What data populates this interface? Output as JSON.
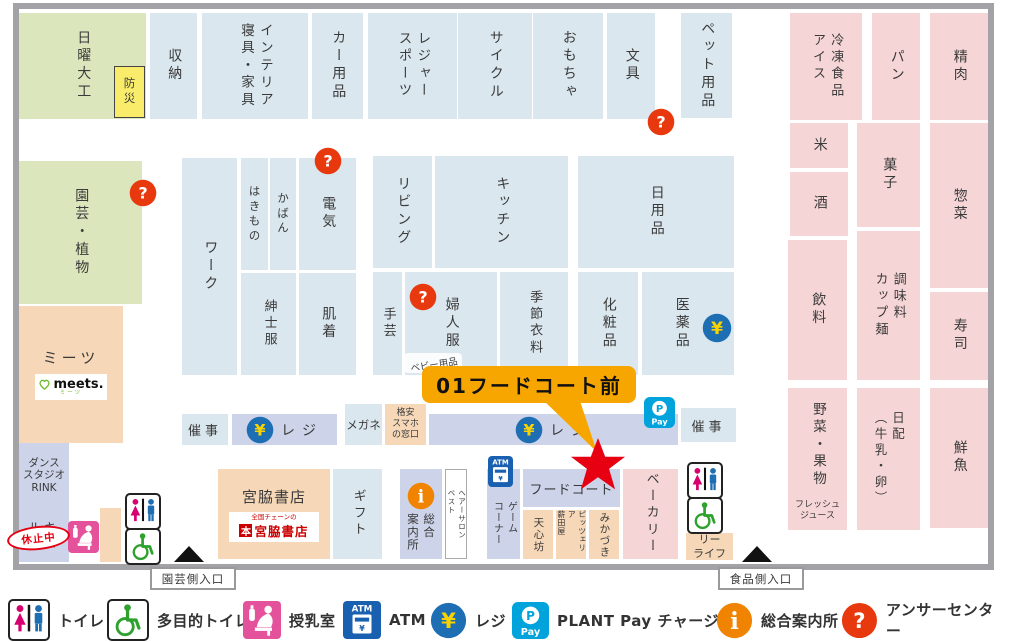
{
  "zones": {
    "sunday_diy": "日曜大工",
    "bosai": "防災",
    "storage": "収納",
    "interior": "インテリア\n寝具・家具",
    "car": "カー用品",
    "leisure": "レジャー\nスポーツ",
    "cycle": "サイクル",
    "toys": "おもちゃ",
    "stationery": "文具",
    "pet": "ペット用品",
    "frozen": "冷凍食品\nアイス",
    "bread": "パン",
    "meat": "精肉",
    "rice": "米",
    "confectionery": "菓子",
    "deli": "惣菜",
    "liquor": "酒",
    "beverages": "飲料",
    "seasoning": "調味料\nカップ麺",
    "sushi": "寿司",
    "produce": "野菜・果物",
    "fresh_juice": "フレッシュ\nジュース",
    "daily_dairy": "日配\n（牛乳・卵）",
    "fish": "鮮魚",
    "gardening": "園芸・植物",
    "meets": "ミーツ",
    "meets_logo": "meets.",
    "meets_logo_sub": "ミーツ",
    "dance_studio": "ダンス\nスタジオ\nRINK",
    "rukimuzu": "ルキ\nムズ",
    "suspended": "休止中",
    "work": "ワーク",
    "footwear": "はきもの",
    "bags": "かばん",
    "electronics": "電気",
    "mens": "紳士服",
    "underwear": "肌着",
    "living": "リビング",
    "kitchen": "キッチン",
    "daily_goods": "日用品",
    "handicraft": "手芸",
    "womens": "婦人服",
    "baby": "ベビー用品",
    "seasonal": "季節衣料",
    "cosmetics": "化粧品",
    "medicine": "医薬品",
    "saiji_left": "催事",
    "saiji_right": "催事",
    "register1": "レジ",
    "register2": "レジ",
    "glasses": "メガネ",
    "smartphone_counter": "格安\nスマホ\nの窓口",
    "miyawaki_title": "宮脇書店",
    "miyawaki_chain": "全国チェーンの",
    "miyawaki_mark": "本",
    "miyawaki_logo": "宮脇書店",
    "gift": "ギフト",
    "info_center": "総合\n案内所",
    "hair_salon": "ヘアーサロン\nベスト",
    "game_corner": "ゲーム\nコーナー",
    "food_court": "フードコート",
    "tenshinbo": "天心坊",
    "pizzeria": "ピッツェリア\n薪田屋",
    "mikazuki": "みかづき",
    "bakery": "ベーカリー",
    "lealife": "リー\nライフ"
  },
  "callout": {
    "text": "01フードコート前"
  },
  "entrances": {
    "garden": "園芸側入口",
    "food": "食品側入口"
  },
  "legend": {
    "items": [
      {
        "icon": "toilet",
        "label": "トイレ"
      },
      {
        "icon": "wheelchair",
        "label": "多目的トイレ"
      },
      {
        "icon": "nursing",
        "label": "授乳室"
      },
      {
        "icon": "atm",
        "label": "ATM"
      },
      {
        "icon": "yen",
        "label": "レジ"
      },
      {
        "icon": "pay",
        "label": "PLANT Pay チャージ機"
      },
      {
        "icon": "info",
        "label": "総合案内所"
      },
      {
        "icon": "question",
        "label": "アンサーセンター"
      }
    ]
  },
  "colors": {
    "zone_blue": "#DAE7EF",
    "zone_pink": "#F5D5D6",
    "zone_green": "#DCE6BD",
    "zone_tan": "#F6D8B8",
    "zone_purple": "#CDD4EA",
    "wall_gray": "#A2A2A7",
    "callout_orange": "#F7A600",
    "star_red": "#E60012",
    "question_red": "#E8380D",
    "yen_blue": "#1E6EB4",
    "yen_yellow": "#F8D300",
    "atm_blue": "#1960B0",
    "pay_cyan": "#00A3DB",
    "nursing_pink": "#E4529B",
    "info_orange": "#F08300",
    "bosai_yellow": "#F8EC6A"
  }
}
